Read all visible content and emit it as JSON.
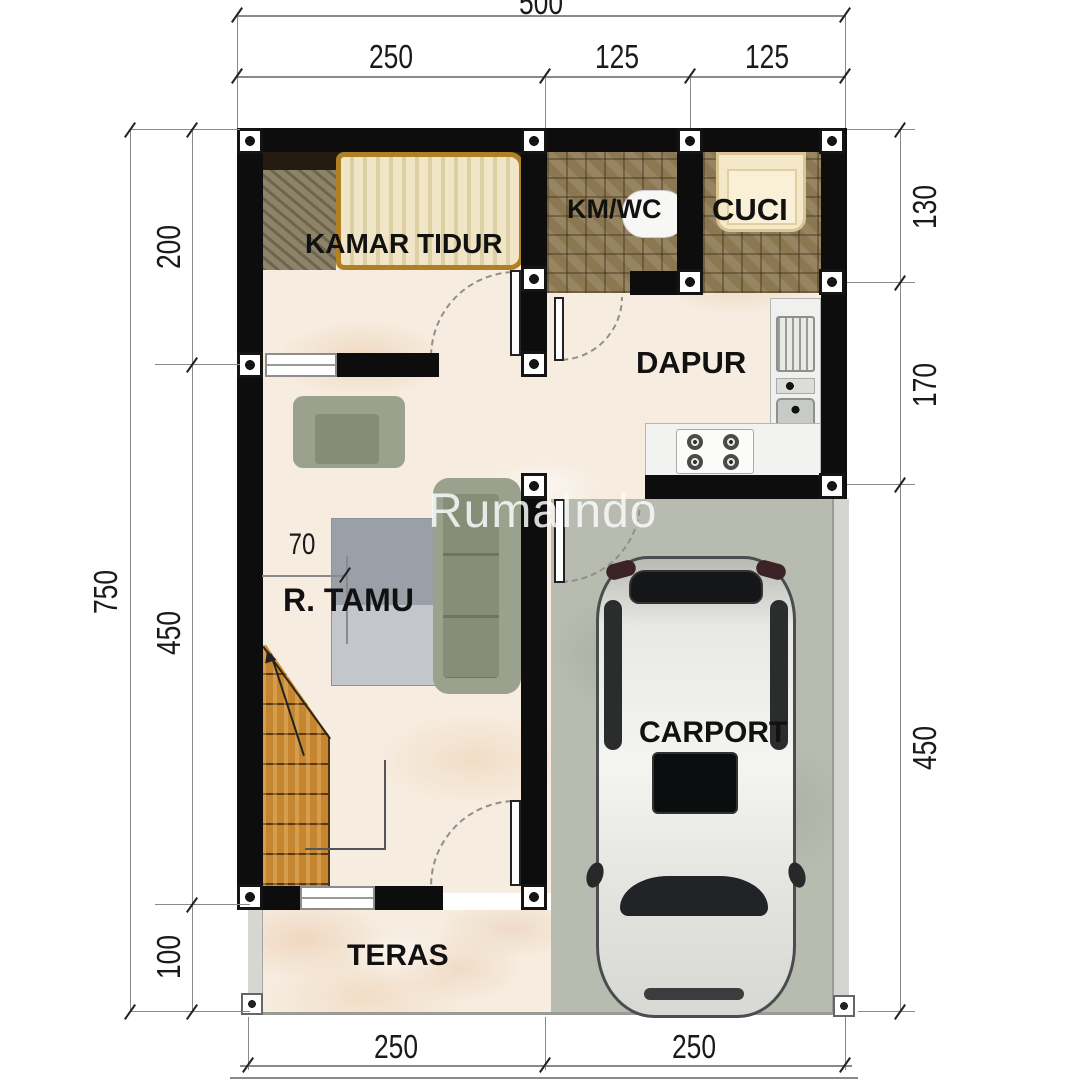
{
  "watermark": "RumaIndo",
  "rooms": {
    "bedroom": "KAMAR TIDUR",
    "bathroom": "KM/WC",
    "laundry": "CUCI",
    "kitchen": "DAPUR",
    "living_room": "R. TAMU",
    "terrace": "TERAS",
    "carport": "CARPORT"
  },
  "dimensions": {
    "top_overall": "500",
    "top_segments": [
      "250",
      "125",
      "125"
    ],
    "left_overall": "750",
    "left_segments": [
      "200",
      "450",
      "100"
    ],
    "right_segments": [
      "130",
      "170",
      "450"
    ],
    "bottom_segments": [
      "250",
      "250"
    ],
    "living_room_offset": "70"
  },
  "colors": {
    "wall": "#0d0d0d",
    "marble_floor": "#f6ecdf",
    "bath_tile": "#8b7853",
    "carport_floor": "#b7bbb0",
    "stair_wood": "#c5862f",
    "sofa": "#9aa18d",
    "dimension_text": "#1a1a1a"
  }
}
